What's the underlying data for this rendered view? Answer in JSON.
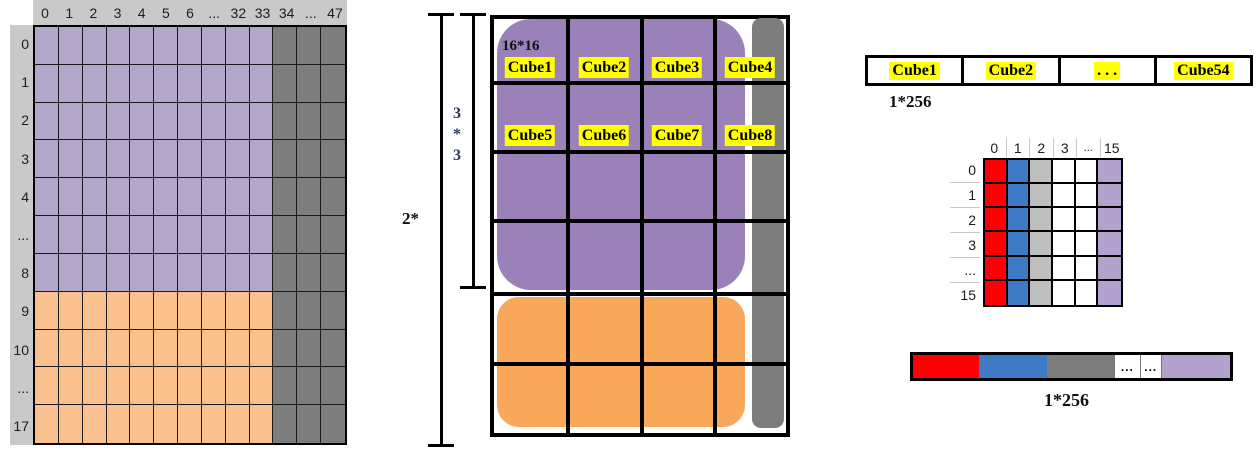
{
  "colors": {
    "left_purple": "#b2a6c9",
    "left_orange": "#fac08e",
    "dark_gray": "#7d7d7d",
    "header_bg": "#c9c9c9",
    "mid_purple": "#9a82b8",
    "mid_orange": "#f9a85b",
    "highlight_yellow": "#ffff00",
    "red": "#fe0000",
    "blue": "#3f7ac5",
    "light_gray": "#bfbfbf",
    "light_purple": "#b3a2ce"
  },
  "left_grid": {
    "col_headers": [
      "0",
      "1",
      "2",
      "3",
      "4",
      "5",
      "6",
      "...",
      "32",
      "33",
      "34",
      "...",
      "47"
    ],
    "row_headers": [
      "0",
      "1",
      "2",
      "3",
      "4",
      "...",
      "8",
      "9",
      "10",
      "...",
      "17"
    ],
    "purple_col_count": 10,
    "purple_row_count": 7
  },
  "middle": {
    "bracket_outer_label": "2*",
    "bracket_inner_lines": [
      "3",
      "*",
      "3"
    ],
    "tile_size_label": "16*16",
    "cube_labels": [
      "Cube1",
      "Cube2",
      "Cube3",
      "Cube4",
      "Cube5",
      "Cube6",
      "Cube7",
      "Cube8"
    ]
  },
  "right": {
    "strip": {
      "cells": [
        "Cube1",
        "Cube2",
        ". . .",
        "Cube54"
      ],
      "caption": "1*256"
    },
    "small_grid": {
      "col_headers": [
        "0",
        "1",
        "2",
        "3",
        "...",
        "15"
      ],
      "row_headers": [
        "0",
        "1",
        "2",
        "3",
        "...",
        "15"
      ],
      "col_colors": [
        "#fe0000",
        "#3f7ac5",
        "#bfbfbf",
        "#ffffff",
        "#ffffff",
        "#b3a2ce"
      ]
    },
    "bar": {
      "segments": [
        {
          "color": "#fe0000",
          "label": ""
        },
        {
          "color": "#3f7ac5",
          "label": ""
        },
        {
          "color": "#7d7d7d",
          "label": ""
        },
        {
          "color": "#ffffff",
          "label": "..."
        },
        {
          "color": "#ffffff",
          "label": "..."
        },
        {
          "color": "#b3a2ce",
          "label": ""
        }
      ],
      "caption": "1*256"
    }
  }
}
